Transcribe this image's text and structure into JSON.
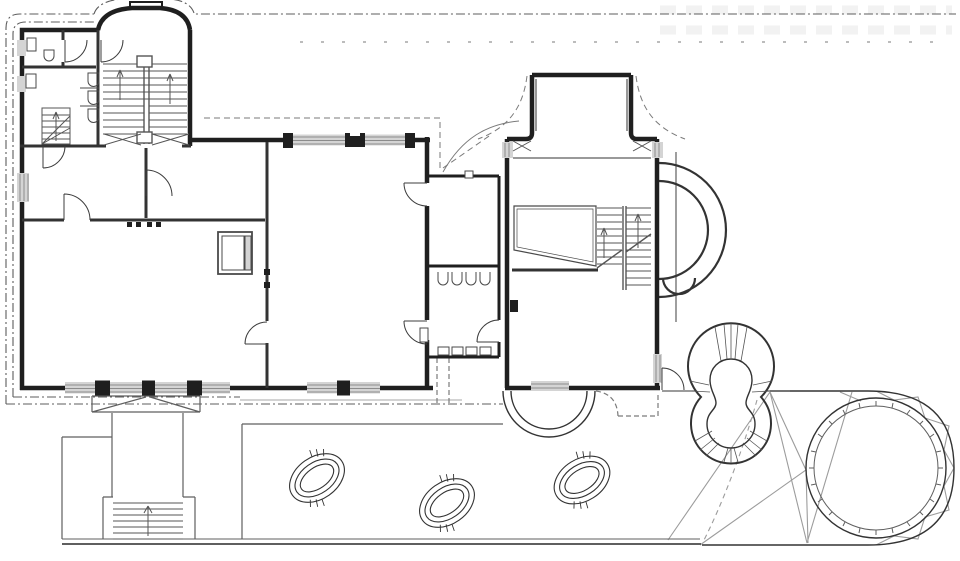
{
  "document": {
    "title": "Ground floor plan",
    "type": "architectural-floor-plan",
    "width_px": 960,
    "height_px": 561
  },
  "palette": {
    "background": "#ffffff",
    "wall": "#1f1f1f",
    "wall_medium": "#333333",
    "thin": "#4a4a4a",
    "stair": "#555555",
    "door": "#3c3c3c",
    "site": "#5c5c5c",
    "roof_dash": "#7a7a7a",
    "terrace": "#5f5f5f",
    "terrace_light": "#8a8a8a",
    "truss": "#9c9c9c",
    "glass": "#d4d4d4",
    "glass_line": "#8c8c8c",
    "faint": "#f2f2f2"
  },
  "features": [
    {
      "id": "left-wing",
      "label": "Left wing: arched stair bay, WC rooms, hall, two large rooms"
    },
    {
      "id": "main-staircase",
      "label": "Main double-flight staircase under arched bay"
    },
    {
      "id": "winder-stair",
      "label": "Small service stair in WC block"
    },
    {
      "id": "connector",
      "label": "Connecting gallery with arched vestibule"
    },
    {
      "id": "right-wing",
      "label": "Right wing with T-shaped north bay and interior stair"
    },
    {
      "id": "east-apse",
      "label": "Semicircular east apse with concentric walls"
    },
    {
      "id": "keyhole-stair",
      "label": "Keyhole-shaped garden feature with radial hatching"
    },
    {
      "id": "round-terrace",
      "label": "Round glazed terrace with triangulated truss ring"
    },
    {
      "id": "skylights",
      "label": "Elliptical terrace skylights",
      "count": 3
    },
    {
      "id": "south-terrace",
      "label": "South terrace with exterior stair and porch"
    },
    {
      "id": "site-boundary",
      "label": "Dash-dot site / roof overhang boundary lines"
    }
  ]
}
